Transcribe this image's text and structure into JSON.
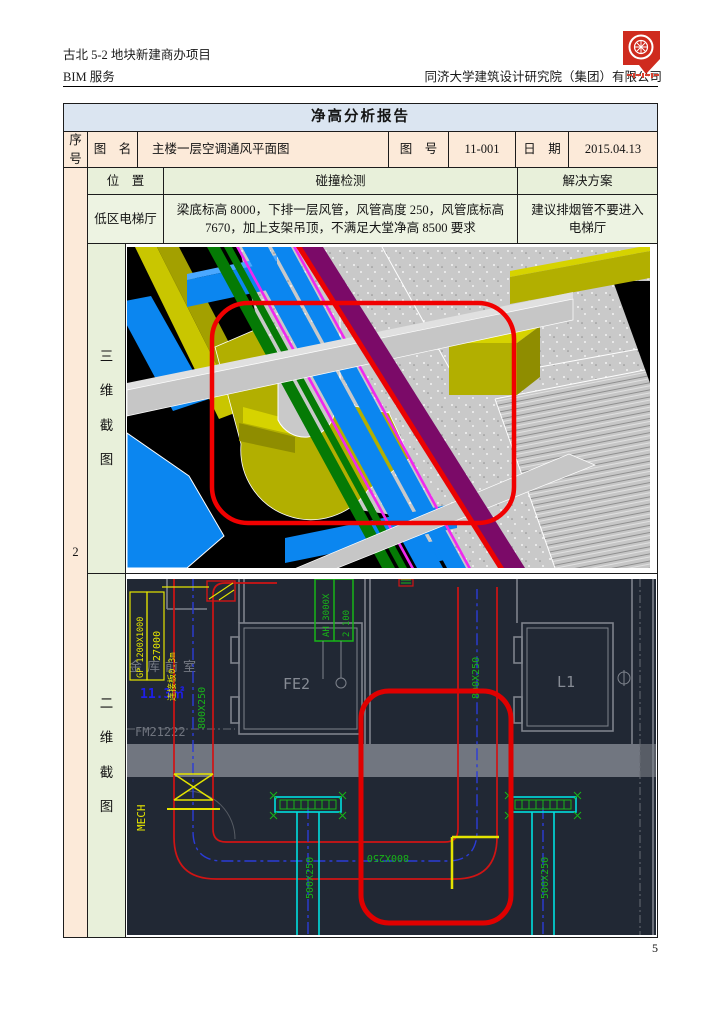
{
  "header": {
    "project": "古北 5-2 地块新建商办项目",
    "service": "BIM 服务",
    "company": "同济大学建筑设计研究院（集团）有限公司"
  },
  "table": {
    "title": "净高分析报告",
    "seq_label": "序号",
    "seq_value": "2",
    "fig_name_label": "图　名",
    "fig_name": "主楼一层空调通风平面图",
    "fig_no_label": "图　号",
    "fig_no": "11-001",
    "date_label": "日　期",
    "date": "2015.04.13",
    "loc_label": "位　置",
    "collision_label": "碰撞检测",
    "solution_label": "解决方案",
    "location": "低区电梯厅",
    "collision": "梁底标高 8000，下排一层风管，风管高度 250，风管底标高 7670，加上支架吊顶，不满足大堂净高 8500 要求",
    "solution": "建议排烟管不要进入电梯厅",
    "view3d_label": "三维截图",
    "view2d_label": "二维截图"
  },
  "cad2d": {
    "room_fe2": "FE2",
    "room_l1": "L1",
    "room_vault": "金库前室",
    "room_area": "11.3㎡",
    "door_code": "FM21222",
    "mech": "MECH",
    "duct_800_left": "800X250",
    "duct_800_mid": "800X250",
    "duct_800_right": "800X250",
    "duct_500_left": "500X250",
    "duct_500_right": "500X250",
    "gp_label": "GP 1200X1000",
    "dim_27000": "27000",
    "slab_note": "连接板0.3m",
    "ahu_label_1": "AH 3000X",
    "ahu_label_2": "2 100"
  },
  "page_number": "5",
  "colors": {
    "title_bg": "#dbe5f1",
    "row_peach": "#fcead9",
    "row_green": "#e8f0da",
    "annotation_red": "#ee0000",
    "cad_bg": "#212834",
    "duct_yellow": "#b2af00",
    "duct_blue": "#0b86f0",
    "pipe_green": "#057a05",
    "pipe_purple": "#7b0a68"
  }
}
